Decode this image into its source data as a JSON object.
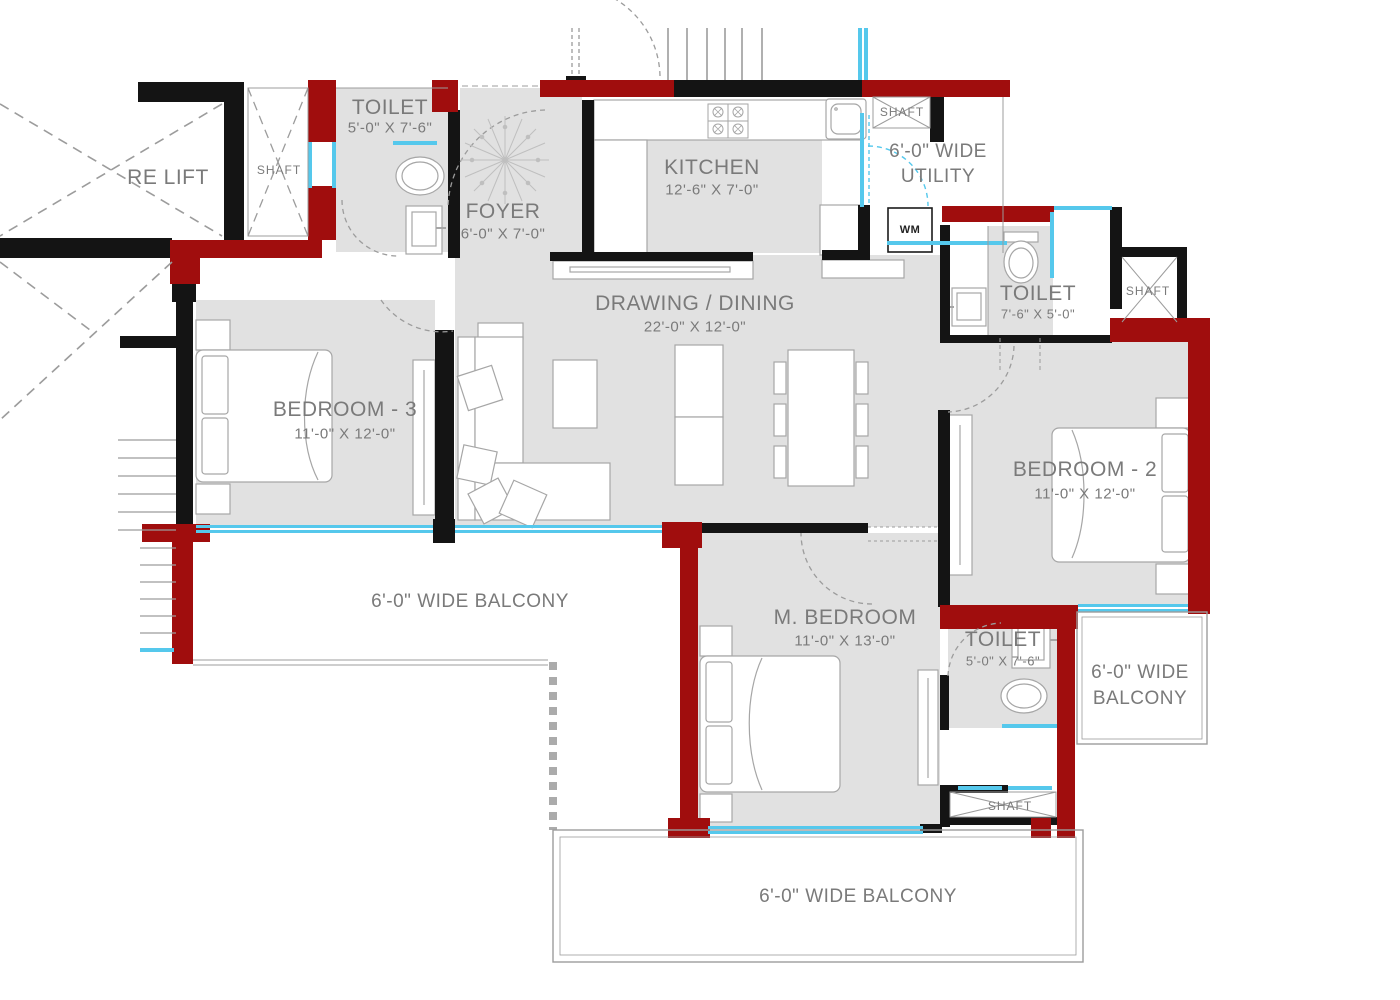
{
  "title": "Apartment Floor Plan",
  "palette": {
    "wall_black": "#141414",
    "wall_red": "#A00D0D",
    "room_fill": "#E1E1E1",
    "window_cyan": "#55C8EC",
    "line_gray": "#9C9C9C",
    "furniture_line": "#A6A6A6",
    "text_gray": "#7A7A7A"
  },
  "rooms": {
    "fire_lift": {
      "name": "RE LIFT"
    },
    "shaft_top_left": {
      "name": "SHAFT"
    },
    "toilet_top": {
      "name": "TOILET",
      "dims": "5'-0\" X 7'-6\""
    },
    "foyer": {
      "name": "FOYER",
      "dims": "6'-0\" X 7'-0\""
    },
    "kitchen": {
      "name": "KITCHEN",
      "dims": "12'-6\" X 7'-0\""
    },
    "shaft_utility": {
      "name": "SHAFT"
    },
    "utility": {
      "line1": "6'-0\" WIDE",
      "line2": "UTILITY"
    },
    "drawing_dining": {
      "name": "DRAWING / DINING",
      "dims": "22'-0\" X 12'-0\""
    },
    "toilet_right": {
      "name": "TOILET",
      "dims": "7'-6\" X 5'-0\""
    },
    "shaft_right": {
      "name": "SHAFT"
    },
    "bedroom_3": {
      "name": "BEDROOM - 3",
      "dims": "11'-0\" X 12'-0\""
    },
    "bedroom_2": {
      "name": "BEDROOM - 2",
      "dims": "11'-0\" X 12'-0\""
    },
    "master_bedroom": {
      "name": "M. BEDROOM",
      "dims": "11'-0\" X 13'-0\""
    },
    "toilet_master": {
      "name": "TOILET",
      "dims": "5'-0\" X 7'-6\""
    },
    "shaft_bottom": {
      "name": "SHAFT"
    },
    "balcony_left": {
      "name": "6'-0\" WIDE BALCONY"
    },
    "balcony_right": {
      "line1": "6'-0\" WIDE",
      "line2": "BALCONY"
    },
    "balcony_bottom": {
      "name": "6'-0\" WIDE BALCONY"
    }
  },
  "appliances": {
    "washing_machine_label": "WM"
  }
}
